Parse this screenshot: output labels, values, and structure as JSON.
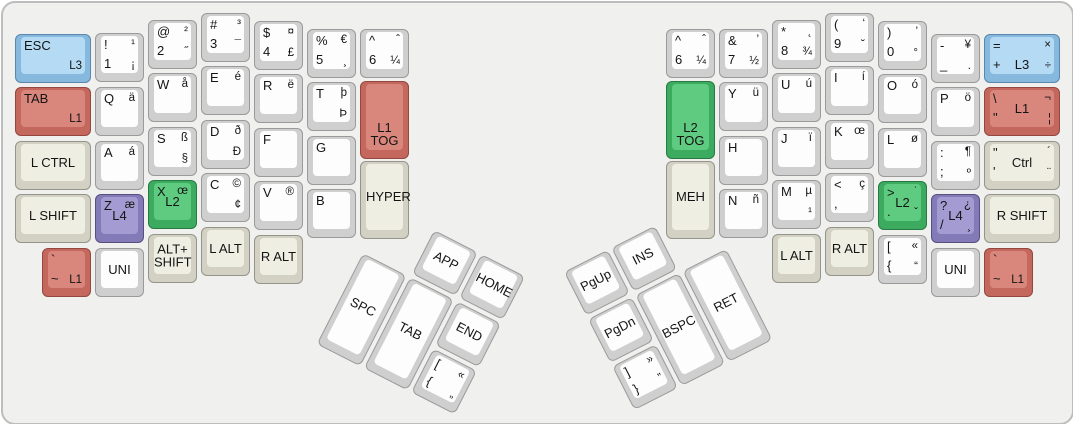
{
  "keyboard": {
    "plate_color": "#f0f0ee",
    "palette": {
      "white_cap": "#fdfdfd",
      "beige_cap": "#efeee2",
      "blue_cap": "#b4dbf3",
      "salmon_cap": "#d9867c",
      "green_cap": "#5fcb80",
      "purple_cap": "#a39bd2"
    },
    "main_keys": [
      {
        "id": "esc-l3",
        "x": 12,
        "y": 31,
        "w": 76,
        "color": "blue",
        "tl": "ESC",
        "br": "L3"
      },
      {
        "id": "tab-l1",
        "x": 12,
        "y": 84,
        "w": 76,
        "color": "salmon",
        "tl": "TAB",
        "br": "L1"
      },
      {
        "id": "lctrl",
        "x": 12,
        "y": 138,
        "w": 76,
        "color": "beige",
        "c": "L CTRL"
      },
      {
        "id": "lshift",
        "x": 12,
        "y": 191,
        "w": 76,
        "color": "beige",
        "c": "L SHIFT"
      },
      {
        "id": "grave-l1-left",
        "x": 39,
        "y": 245,
        "color": "salmon",
        "tl": "`",
        "bl": "~",
        "br": "L1"
      },
      {
        "id": "1",
        "x": 92,
        "y": 30,
        "color": "white",
        "tl": "!",
        "tr": "¹",
        "bl": "1",
        "br": "¡"
      },
      {
        "id": "q",
        "x": 92,
        "y": 84,
        "color": "white",
        "tl": "Q",
        "tr": "ä"
      },
      {
        "id": "a",
        "x": 92,
        "y": 138,
        "color": "white",
        "tl": "A",
        "tr": "á"
      },
      {
        "id": "z-l4",
        "x": 92,
        "y": 191,
        "color": "purple",
        "tl": "Z",
        "tr": "æ",
        "c": "L4"
      },
      {
        "id": "uni-left",
        "x": 92,
        "y": 245,
        "color": "white",
        "c": "UNI"
      },
      {
        "id": "2",
        "x": 145,
        "y": 17,
        "color": "white",
        "tl": "@",
        "tr": "²",
        "bl": "2",
        "br": "˝"
      },
      {
        "id": "w",
        "x": 145,
        "y": 70,
        "color": "white",
        "tl": "W",
        "tr": "å"
      },
      {
        "id": "s",
        "x": 145,
        "y": 124,
        "color": "white",
        "tl": "S",
        "tr": "ß",
        "br": "§"
      },
      {
        "id": "x-l2",
        "x": 145,
        "y": 177,
        "color": "green",
        "tl": "X",
        "tr": "œ",
        "c": "L2"
      },
      {
        "id": "alt-shift",
        "x": 145,
        "y": 231,
        "color": "beige",
        "c": "ALT+\nSHIFT"
      },
      {
        "id": "3",
        "x": 198,
        "y": 10,
        "color": "white",
        "tl": "#",
        "tr": "³",
        "bl": "3",
        "br": "¯"
      },
      {
        "id": "e",
        "x": 198,
        "y": 63,
        "color": "white",
        "tl": "E",
        "tr": "é"
      },
      {
        "id": "d",
        "x": 198,
        "y": 117,
        "color": "white",
        "tl": "D",
        "tr": "ð",
        "br": "Ð"
      },
      {
        "id": "c",
        "x": 198,
        "y": 170,
        "color": "white",
        "tl": "C",
        "tr": "©",
        "br": "¢"
      },
      {
        "id": "lalt-left",
        "x": 198,
        "y": 224,
        "color": "beige",
        "c": "L ALT"
      },
      {
        "id": "4",
        "x": 251,
        "y": 18,
        "color": "white",
        "tl": "$",
        "tr": "¤",
        "bl": "4",
        "br": "£"
      },
      {
        "id": "r",
        "x": 251,
        "y": 71,
        "color": "white",
        "tl": "R",
        "tr": "ë"
      },
      {
        "id": "f",
        "x": 251,
        "y": 125,
        "color": "white",
        "tl": "F"
      },
      {
        "id": "v",
        "x": 251,
        "y": 178,
        "color": "white",
        "tl": "V",
        "tr": "®"
      },
      {
        "id": "ralt-left",
        "x": 251,
        "y": 232,
        "color": "beige",
        "c": "R ALT"
      },
      {
        "id": "5",
        "x": 304,
        "y": 26,
        "color": "white",
        "tl": "%",
        "tr": "€",
        "bl": "5",
        "br": "¸"
      },
      {
        "id": "t",
        "x": 304,
        "y": 79,
        "color": "white",
        "tl": "T",
        "tr": "þ",
        "br": "Þ"
      },
      {
        "id": "g",
        "x": 304,
        "y": 133,
        "color": "white",
        "tl": "G"
      },
      {
        "id": "b",
        "x": 304,
        "y": 186,
        "color": "white",
        "tl": "B"
      },
      {
        "id": "6-left",
        "x": 357,
        "y": 26,
        "color": "white",
        "tl": "^",
        "tr": "ˆ",
        "bl": "6",
        "br": "¼"
      },
      {
        "id": "l1-tog",
        "x": 357,
        "y": 78,
        "h": 78,
        "color": "salmon",
        "c": "L1\nTOG",
        "cb": true
      },
      {
        "id": "hyper",
        "x": 357,
        "y": 158,
        "h": 78,
        "color": "beige",
        "c": "HYPER"
      },
      {
        "id": "6-right",
        "x": 663,
        "y": 26,
        "color": "white",
        "tl": "^",
        "tr": "ˆ",
        "bl": "6",
        "br": "¼"
      },
      {
        "id": "l2-tog",
        "x": 663,
        "y": 78,
        "h": 78,
        "color": "green",
        "c": "L2\nTOG",
        "cb": true
      },
      {
        "id": "meh",
        "x": 663,
        "y": 158,
        "h": 78,
        "color": "beige",
        "c": "MEH"
      },
      {
        "id": "7",
        "x": 716,
        "y": 26,
        "color": "white",
        "tl": "&",
        "tr": "’",
        "bl": "7",
        "br": "½"
      },
      {
        "id": "y",
        "x": 716,
        "y": 79,
        "color": "white",
        "tl": "Y",
        "tr": "ü"
      },
      {
        "id": "h",
        "x": 716,
        "y": 133,
        "color": "white",
        "tl": "H"
      },
      {
        "id": "n",
        "x": 716,
        "y": 186,
        "color": "white",
        "tl": "N",
        "tr": "ñ"
      },
      {
        "id": "8",
        "x": 769,
        "y": 17,
        "color": "white",
        "tl": "*",
        "tr": "˛",
        "bl": "8",
        "br": "¾"
      },
      {
        "id": "u",
        "x": 769,
        "y": 70,
        "color": "white",
        "tl": "U",
        "tr": "ú"
      },
      {
        "id": "j",
        "x": 769,
        "y": 124,
        "color": "white",
        "tl": "J",
        "tr": "ï"
      },
      {
        "id": "m",
        "x": 769,
        "y": 177,
        "color": "white",
        "tl": "M",
        "tr": "µ",
        "br": "¹"
      },
      {
        "id": "lalt-right",
        "x": 769,
        "y": 231,
        "color": "beige",
        "c": "L ALT"
      },
      {
        "id": "9",
        "x": 822,
        "y": 10,
        "color": "white",
        "tl": "(",
        "tr": "‘",
        "bl": "9",
        "br": "˘"
      },
      {
        "id": "i",
        "x": 822,
        "y": 63,
        "color": "white",
        "tl": "I",
        "tr": "í"
      },
      {
        "id": "k",
        "x": 822,
        "y": 117,
        "color": "white",
        "tl": "K",
        "tr": "œ"
      },
      {
        "id": "comma",
        "x": 822,
        "y": 170,
        "color": "white",
        "tl": "<",
        "tr": "ç",
        "bl": ","
      },
      {
        "id": "ralt-right",
        "x": 822,
        "y": 224,
        "color": "beige",
        "c": "R ALT"
      },
      {
        "id": "0",
        "x": 875,
        "y": 18,
        "color": "white",
        "tl": ")",
        "tr": "’",
        "bl": "0",
        "br": "°"
      },
      {
        "id": "o",
        "x": 875,
        "y": 71,
        "color": "white",
        "tl": "O",
        "tr": "ó"
      },
      {
        "id": "l",
        "x": 875,
        "y": 125,
        "color": "white",
        "tl": "L",
        "tr": "ø"
      },
      {
        "id": "period-l2",
        "x": 875,
        "y": 178,
        "color": "green",
        "tl": ">",
        "tr": "˙",
        "bl": ".",
        "br": "ˇ",
        "c": "L2"
      },
      {
        "id": "lbracket-right",
        "x": 875,
        "y": 232,
        "color": "white",
        "tl": "[",
        "tr": "«",
        "bl": "{",
        "br": "“"
      },
      {
        "id": "minus",
        "x": 928,
        "y": 31,
        "color": "white",
        "tl": "-",
        "tr": "¥",
        "bl": "_",
        "br": "."
      },
      {
        "id": "p",
        "x": 928,
        "y": 84,
        "color": "white",
        "tl": "P",
        "tr": "ö"
      },
      {
        "id": "semicolon",
        "x": 928,
        "y": 138,
        "color": "white",
        "tl": ":",
        "tr": "¶",
        "bl": ";",
        "br": "º"
      },
      {
        "id": "slash-l4",
        "x": 928,
        "y": 191,
        "color": "purple",
        "tl": "?",
        "tr": "¿",
        "bl": "/",
        "br": "¸",
        "c": "L4"
      },
      {
        "id": "uni-right",
        "x": 928,
        "y": 245,
        "color": "white",
        "c": "UNI"
      },
      {
        "id": "equals-l3",
        "x": 981,
        "y": 31,
        "w": 76,
        "color": "blue",
        "tl": "=",
        "tr": "×",
        "bl": "+",
        "br": "÷",
        "c": "L3",
        "cb": true
      },
      {
        "id": "backslash-l1",
        "x": 981,
        "y": 84,
        "w": 76,
        "color": "salmon",
        "tl": "\\",
        "tr": "¬",
        "bl": "\"",
        "br": "¦",
        "c": "L1"
      },
      {
        "id": "quote-ctrl",
        "x": 981,
        "y": 138,
        "w": 76,
        "color": "beige",
        "tl": "\"",
        "tr": "´",
        "bl": "'",
        "br": "¨",
        "c": "Ctrl"
      },
      {
        "id": "rshift",
        "x": 981,
        "y": 191,
        "w": 76,
        "color": "beige",
        "c": "R SHIFT"
      },
      {
        "id": "grave-l1-right",
        "x": 981,
        "y": 245,
        "color": "salmon",
        "tl": "`",
        "bl": "~",
        "br": "L1"
      }
    ],
    "thumb_clusters": [
      {
        "id": "left",
        "x": 384,
        "y": 203,
        "angle": 27,
        "keys": [
          {
            "id": "app",
            "x": 53,
            "y": 0,
            "color": "white",
            "c": "APP"
          },
          {
            "id": "home",
            "x": 106,
            "y": 0,
            "color": "white",
            "c": "HOME"
          },
          {
            "id": "spc",
            "x": 0,
            "y": 53,
            "h": 102,
            "color": "white",
            "c": "SPC"
          },
          {
            "id": "tab-thumb",
            "x": 53,
            "y": 53,
            "h": 102,
            "color": "white",
            "c": "TAB"
          },
          {
            "id": "end",
            "x": 106,
            "y": 53,
            "color": "white",
            "c": "END"
          },
          {
            "id": "lbracket-thumb",
            "x": 106,
            "y": 106,
            "color": "white",
            "tl": "[",
            "tr": "«",
            "bl": "{",
            "br": "„"
          }
        ]
      },
      {
        "id": "right",
        "x": 561,
        "y": 269,
        "angle": -27,
        "keys": [
          {
            "id": "pgup",
            "x": 0,
            "y": 0,
            "color": "white",
            "c": "PgUp"
          },
          {
            "id": "ins",
            "x": 53,
            "y": 0,
            "color": "white",
            "c": "INS"
          },
          {
            "id": "pgdn",
            "x": 0,
            "y": 53,
            "color": "white",
            "c": "PgDn"
          },
          {
            "id": "rbracket-thumb",
            "x": 0,
            "y": 106,
            "color": "white",
            "tl": "]",
            "tr": "»",
            "bl": "}",
            "br": "”"
          },
          {
            "id": "bspc",
            "x": 53,
            "y": 53,
            "h": 102,
            "color": "white",
            "c": "BSPC"
          },
          {
            "id": "ret",
            "x": 106,
            "y": 53,
            "h": 102,
            "color": "white",
            "c": "RET"
          }
        ]
      }
    ]
  }
}
